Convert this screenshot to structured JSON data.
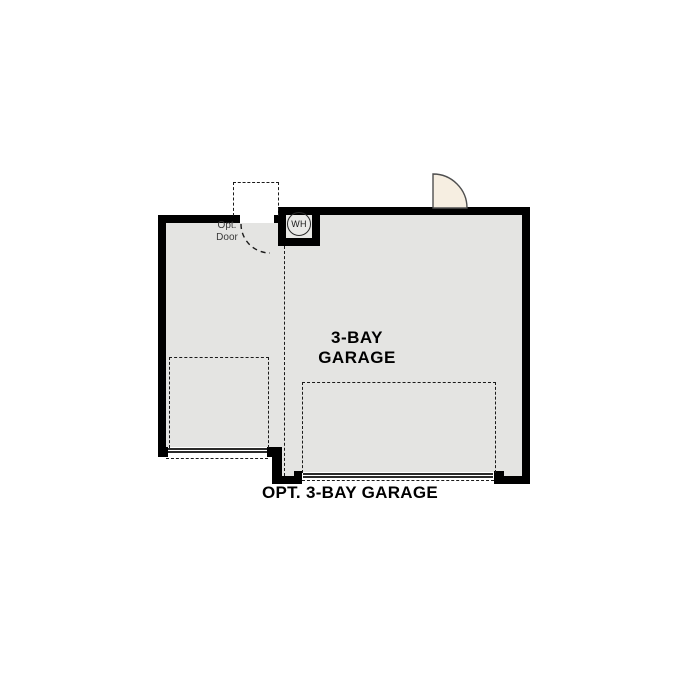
{
  "plan": {
    "caption": "OPT. 3-BAY GARAGE",
    "main_room": {
      "label_line1": "3-BAY",
      "label_line2": "GARAGE"
    },
    "opt_door_label": {
      "line1": "Opt.",
      "line2": "Door"
    },
    "water_heater_label": "WH",
    "colors": {
      "wall": "#000000",
      "floor": "#e4e4e2",
      "door_leaf": "#f6eee1",
      "dashed_line": "#1a1a1a",
      "background": "#ffffff",
      "label_text": "#000000",
      "secondary_text": "#3a3a3a"
    }
  }
}
